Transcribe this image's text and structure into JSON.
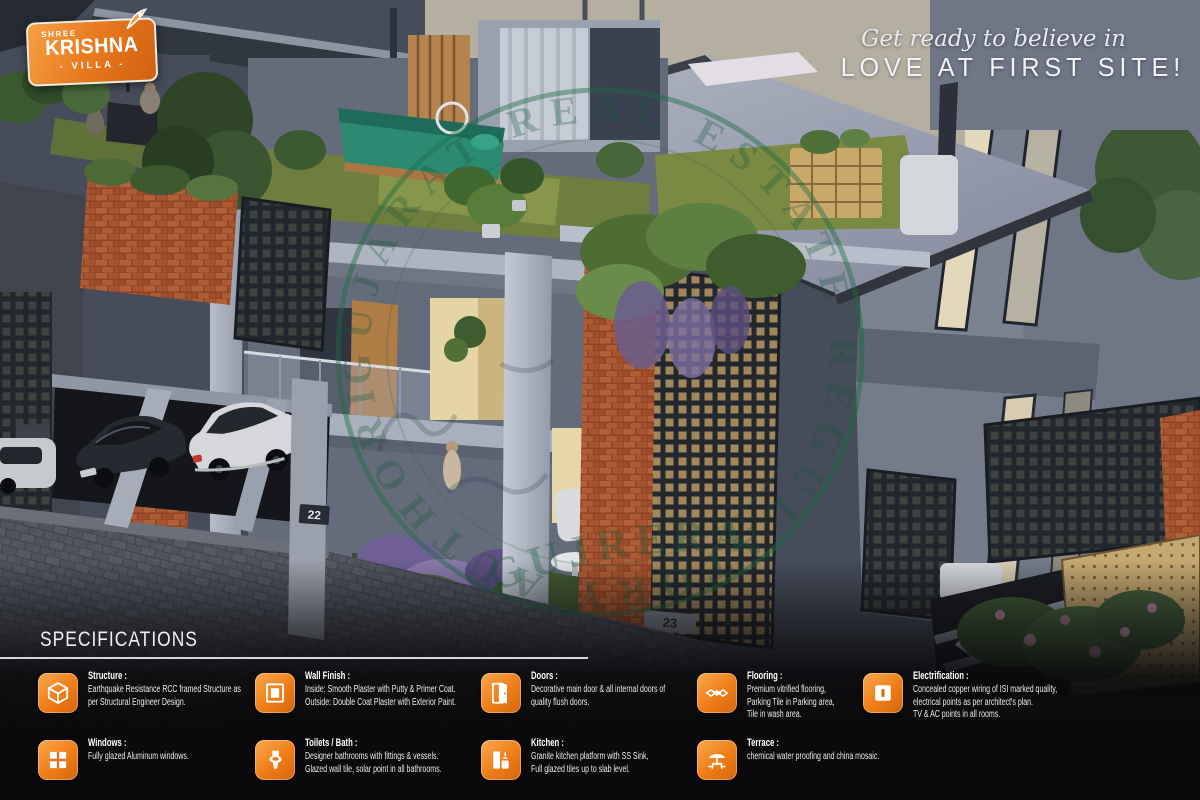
{
  "brand": {
    "shree": "SHREE",
    "name": "KRISHNA",
    "sub": "- VILLA -"
  },
  "tagline": {
    "line1": "Get ready to believe in",
    "line2": "LOVE AT FIRST SITE!"
  },
  "watermark": {
    "ring_text": "GUJARAT REAL ESTATE REGULATORY AUTHORITY",
    "stamp_text": "GUJRERA"
  },
  "scene": {
    "villa_numbers": [
      "22",
      "23"
    ]
  },
  "specifications": {
    "title": "SPECIFICATIONS",
    "items": [
      {
        "icon": "structure-icon",
        "title": "Structure :",
        "lines": [
          "Earthquake Resistance RCC framed Structure as",
          "per Structural Engineer Design."
        ]
      },
      {
        "icon": "wall-finish-icon",
        "title": "Wall Finish :",
        "lines": [
          "Inside: Smooth Plaster with Putty & Primer Coat.",
          "Outside: Double Coat Plaster with Exterior Paint."
        ]
      },
      {
        "icon": "doors-icon",
        "title": "Doors :",
        "lines": [
          "Decorative main door & all internal doors of",
          "quality flush doors."
        ]
      },
      {
        "icon": "flooring-icon",
        "title": "Flooring :",
        "lines": [
          "Premium vitrified flooring,",
          "Parking Tile in Parking area,",
          "Tile in wash area."
        ]
      },
      {
        "icon": "electrification-icon",
        "title": "Electrification :",
        "lines": [
          "Concealed copper wiring of ISI marked quality,",
          "electrical points as per architect's plan.",
          "TV & AC points in all rooms."
        ]
      },
      {
        "icon": "windows-icon",
        "title": "Windows :",
        "lines": [
          "Fully glazed Aluminum windows."
        ]
      },
      {
        "icon": "toilets-icon",
        "title": "Toilets / Bath :",
        "lines": [
          "Designer bathrooms with fittings & vessels.",
          "Glazed wall tile, solar point in all bathrooms."
        ]
      },
      {
        "icon": "kitchen-icon",
        "title": "Kitchen :",
        "lines": [
          "Granite kitchen platform with SS Sink,",
          "Full glazed tiles up to slab level."
        ]
      },
      {
        "icon": "terrace-icon",
        "title": "Terrace :",
        "lines": [
          "chemical water proofing and china mosaic."
        ]
      }
    ]
  },
  "colors": {
    "accent_orange": "#E87A1F",
    "spec_bg": "#0A0A0C",
    "watermark_green": "#1D6B44"
  }
}
